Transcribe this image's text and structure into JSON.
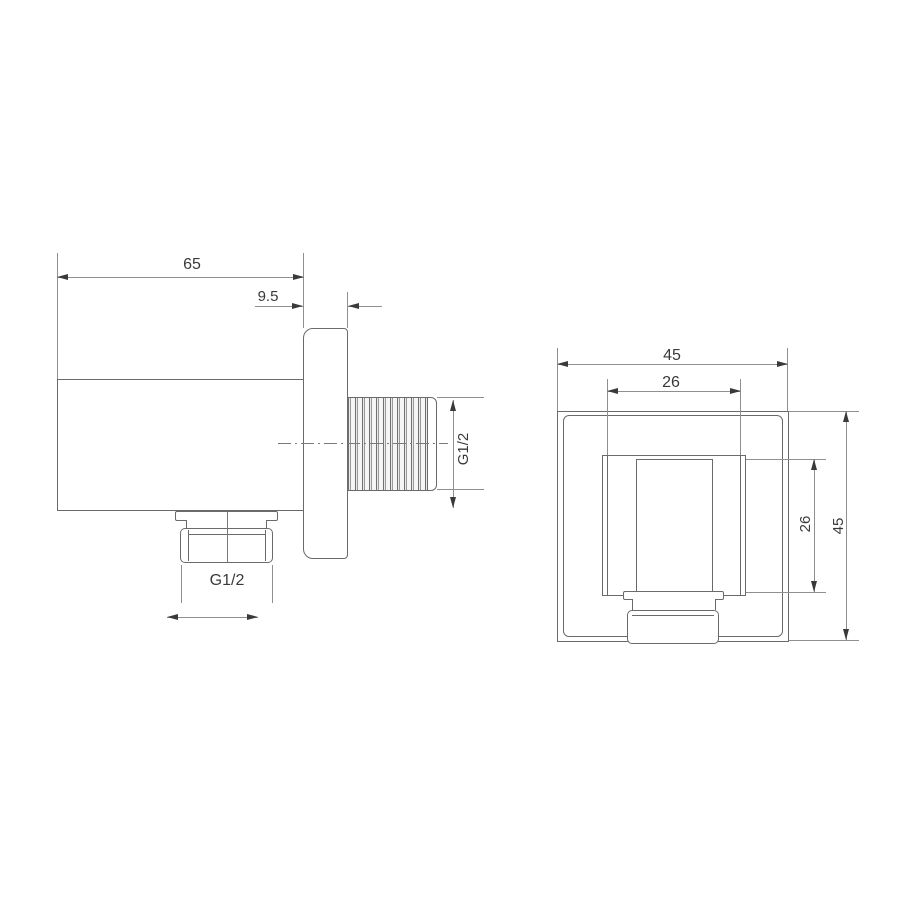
{
  "drawing": {
    "type": "technical-dimension-drawing",
    "subject": "wall-outlet-elbow-fitting",
    "units_shown": false
  },
  "colors": {
    "background": "#ffffff",
    "geometry_line": "#6a6a6a",
    "dimension_line": "#8f8f8f",
    "text": "#3a3a3a"
  },
  "views": {
    "side_view": {
      "dimensions": {
        "depth": "65",
        "plate_thickness": "9.5",
        "outlet_thread": "G1/2",
        "bottom_thread": "G1/2"
      }
    },
    "front_view": {
      "dimensions": {
        "plate_width": "45",
        "body_width": "26",
        "body_height": "26",
        "plate_height": "45"
      }
    }
  }
}
